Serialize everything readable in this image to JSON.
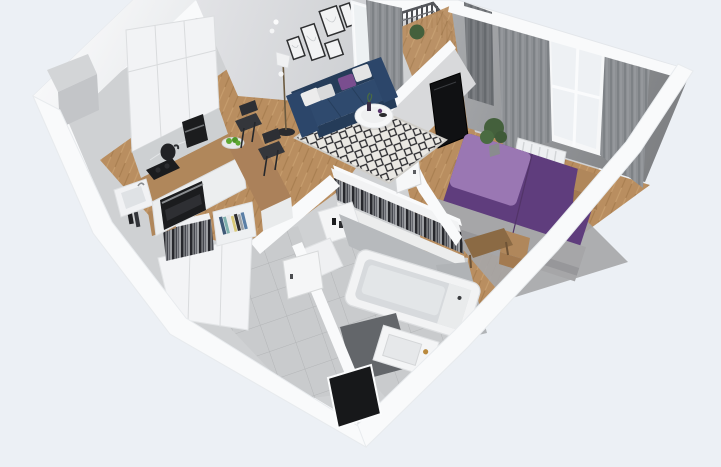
{
  "scene": {
    "title": "3D isometric cutaway render of a one-bedroom apartment floor plan",
    "view": "isometric cutaway, no text labels",
    "canvas": {
      "width": 721,
      "height": 467
    },
    "rooms": [
      {
        "name": "kitchen",
        "items": [
          "white-upper-cabinets",
          "marble-backsplash",
          "black-cooktop",
          "black-oven",
          "coffee-machine",
          "black-kettle",
          "l-shaped-wood-counter",
          "wood-bar-counter",
          "fruit-bowl-green-apples",
          "white-sink-cabinet",
          "two-dark-bar-chairs",
          "wall-duct-column"
        ]
      },
      {
        "name": "living-room",
        "items": [
          "navy-three-seat-sofa",
          "white-gray-purple-throw-pillows",
          "round-white-coffee-table",
          "black-white-diamond-rug",
          "herringbone-wood-floor",
          "floor-lamp",
          "gallery-wall-five-frames",
          "two-wall-sconces"
        ]
      },
      {
        "name": "balcony",
        "items": [
          "metal-bar-railing",
          "wood-deck",
          "potted-plant",
          "glass-door",
          "sheer-curtain",
          "gray-curtain"
        ]
      },
      {
        "name": "bedroom",
        "items": [
          "double-bed-purple-duvet",
          "lavender-head-section",
          "gray-knit-throw",
          "two-wood-nightstands",
          "wall-mounted-tv",
          "window-with-white-frame",
          "gray-curtain-pair",
          "white-radiator",
          "potted-plant",
          "wood-bench",
          "gray-area-rug",
          "white-door-ajar"
        ]
      },
      {
        "name": "walk-in-closet",
        "items": [
          "open-rail-hanging-clothes",
          "white-dresser-with-black-bottles"
        ]
      },
      {
        "name": "hallway",
        "items": [
          "open-wardrobe-hanging-clothes",
          "bookshelf-with-books",
          "white-cabinet-fronts",
          "wood-cube-shelf",
          "gray-tile-floor",
          "dark-entry-door"
        ]
      },
      {
        "name": "bathroom",
        "items": [
          "white-bathtub",
          "vanity-with-basin",
          "brass-faucet",
          "dark-gray-floor-mat",
          "gray-tile-floor",
          "marble-wall-faces",
          "white-door-ajar",
          "shower-partition"
        ]
      }
    ]
  },
  "palette": {
    "bg": "#ecf0f5",
    "wall": "#f9fafb",
    "wallshade": "#e4e7ea",
    "wallface": "#dcdde0",
    "wood": "#b98e60",
    "woodline": "#a87e50",
    "woodlight": "#c79e6e",
    "woodfurn": "#b0875b",
    "tile": "#c9cbcd",
    "tileline": "#b3b5b7",
    "marble": "#b7babd",
    "rugbase": "#eae8e3",
    "rugline": "#28282c",
    "sofa": "#2f4a6e",
    "sofadark": "#253c59",
    "pillowpurple": "#7a4e8f",
    "bed": "#5f3d7d",
    "bedlight": "#9a77b3",
    "blanket": "#a6a6a8",
    "curtain": "#8d9094",
    "curtaindark": "#73767a",
    "clothesbg": "#b9bbbe",
    "clothesdark": "#26272c",
    "appliance": "#1b1c1e",
    "tv": "#101113",
    "entry": "#17181a",
    "brass": "#b9893c",
    "plant": "#44603c",
    "applegreen": "#5fa832"
  }
}
